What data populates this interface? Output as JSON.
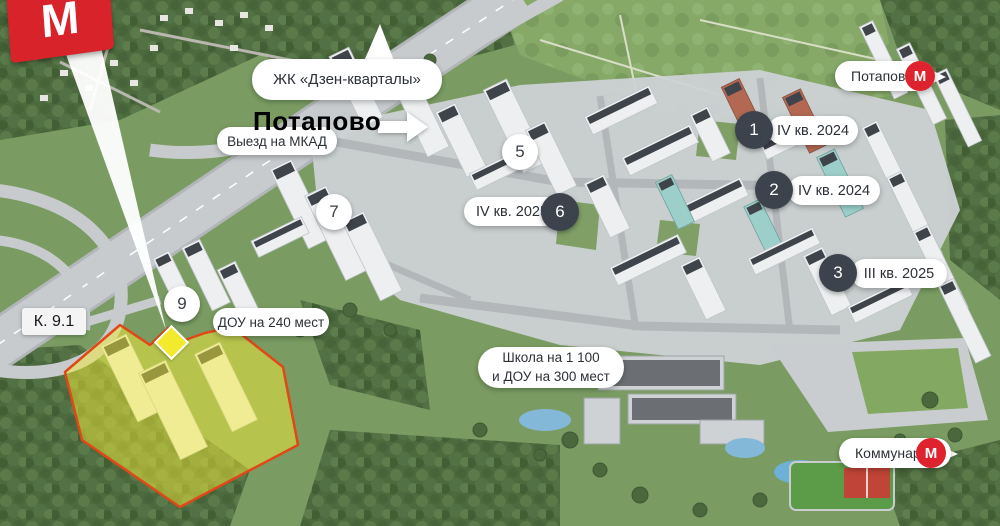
{
  "metro_logo": {
    "letter": "М"
  },
  "callouts": {
    "complex": "ЖК «Дзен-кварталы»",
    "district_bold": "Потапово",
    "mkad_exit": "Выезд на МКАД",
    "dou_240": "ДОУ на 240 мест",
    "building_code": "К. 9.1",
    "school_line1": "Школа на 1 100",
    "school_line2": "и ДОУ на 300 мест"
  },
  "metro_stations": [
    {
      "name": "Потапово",
      "letter": "М"
    },
    {
      "name": "Коммунарка",
      "letter": "М"
    }
  ],
  "phase_markers": [
    {
      "num": "1",
      "completion": "IV кв. 2024",
      "style": "dark"
    },
    {
      "num": "2",
      "completion": "IV кв. 2024",
      "style": "dark"
    },
    {
      "num": "3",
      "completion": "III кв. 2025",
      "style": "dark"
    },
    {
      "num": "5",
      "style": "light"
    },
    {
      "num": "6",
      "completion": "IV кв. 2025",
      "style": "dark"
    },
    {
      "num": "7",
      "style": "light"
    },
    {
      "num": "9",
      "style": "light"
    }
  ],
  "colors": {
    "metro_red": "#df232e",
    "marker_dark": "#3d434c",
    "highlight_yellow": "#f2e935",
    "highlight_border": "#e04818",
    "pill_bg": "#ffffff"
  }
}
